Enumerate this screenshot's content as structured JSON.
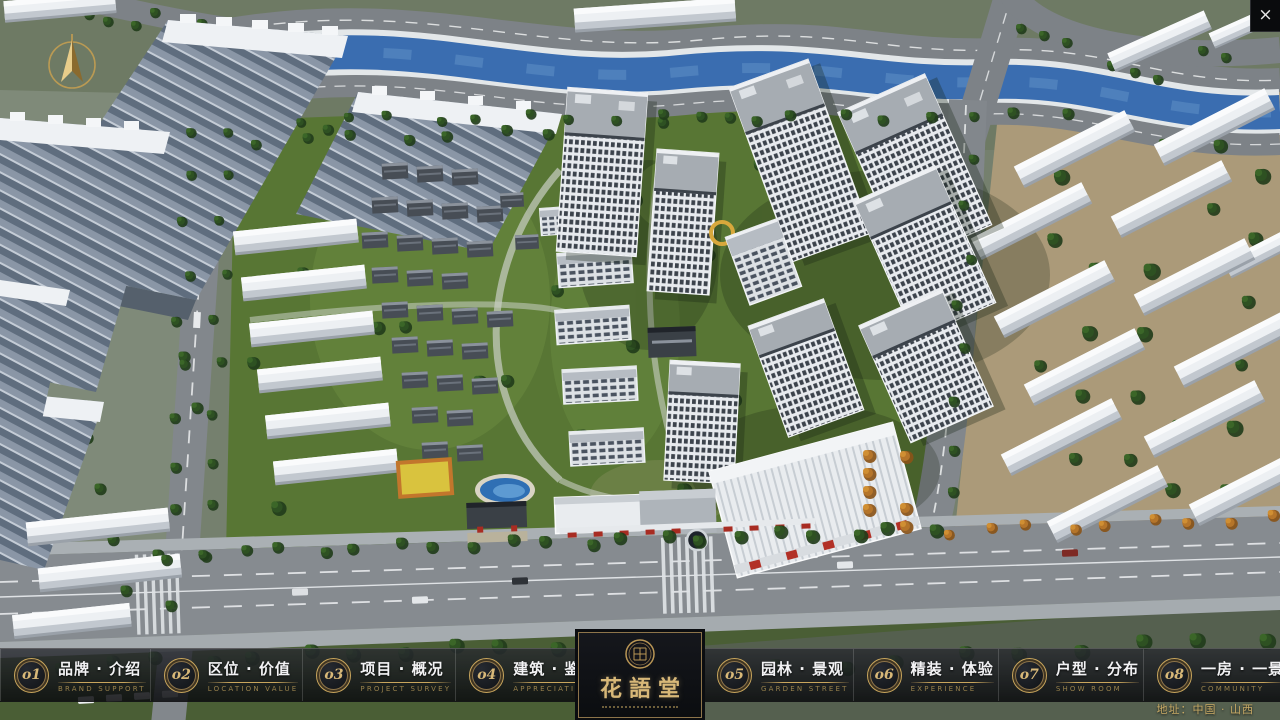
{
  "hud": {
    "close_glyph": "×"
  },
  "navbar": {
    "items": [
      {
        "num": "o1",
        "zh": "品牌 · 介绍",
        "en": "BRAND SUPPORT"
      },
      {
        "num": "o2",
        "zh": "区位 · 价值",
        "en": "LOCATION VALUE"
      },
      {
        "num": "o3",
        "zh": "项目 · 概况",
        "en": "PROJECT SURVEY"
      },
      {
        "num": "o4",
        "zh": "建筑 · 鉴赏",
        "en": "APPRECIATION"
      },
      {
        "num": "o5",
        "zh": "园林 · 景观",
        "en": "GARDEN STREET"
      },
      {
        "num": "o6",
        "zh": "精装 · 体验",
        "en": "EXPERIENCE"
      },
      {
        "num": "o7",
        "zh": "户型 · 分布",
        "en": "SHOW ROOM"
      },
      {
        "num": "o8",
        "zh": "一房 · 一景",
        "en": "COMMUNITY"
      }
    ]
  },
  "logo": {
    "title": "花語堂"
  },
  "footer": {
    "address": "地址：中国 · 山西"
  },
  "colors": {
    "accent_gold": "#c8a55c",
    "navbar_bg": "#14161a",
    "river_blue": "#3a6db0",
    "foliage_green": "#3b6628"
  }
}
